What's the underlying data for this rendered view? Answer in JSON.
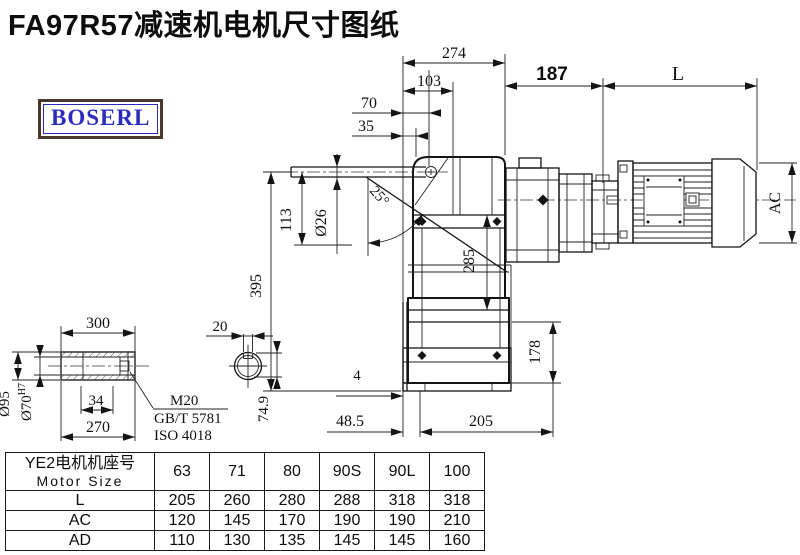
{
  "title": "FA97R57减速机电机尺寸图纸",
  "logo": {
    "text": "BOSERL"
  },
  "colors": {
    "line": "#141414",
    "title": "#0d0d0d",
    "logo_text": "#2b2bc0",
    "logo_border": "#4b382c"
  },
  "drawing": {
    "dims": {
      "d274": "274",
      "d103": "103",
      "d70": "70",
      "d35": "35",
      "d187": "187",
      "dL": "L",
      "dAC": "AC",
      "d395": "395",
      "d113": "113",
      "d26": "Ø26",
      "d25": "25°",
      "d285": "285",
      "d178": "178",
      "d4": "4",
      "d48_5": "48.5",
      "d205": "205"
    },
    "shaft_detail": {
      "d300": "300",
      "d270": "270",
      "d34": "34",
      "d95": "Ø95",
      "d70h7_base": "Ø70",
      "d70h7_sup": "H7",
      "d20": "20",
      "d74_9": "74.9",
      "m20": "M20",
      "gbt": "GB/T 5781",
      "iso": "ISO 4018"
    }
  },
  "table": {
    "header_cn": "YE2电机机座号",
    "header_en": "Motor Size",
    "columns": [
      "63",
      "71",
      "80",
      "90S",
      "90L",
      "100"
    ],
    "rows": [
      {
        "label": "L",
        "values": [
          "205",
          "260",
          "280",
          "288",
          "318",
          "318"
        ]
      },
      {
        "label": "AC",
        "values": [
          "120",
          "145",
          "170",
          "190",
          "190",
          "210"
        ]
      },
      {
        "label": "AD",
        "values": [
          "110",
          "130",
          "135",
          "145",
          "145",
          "160"
        ]
      }
    ]
  }
}
